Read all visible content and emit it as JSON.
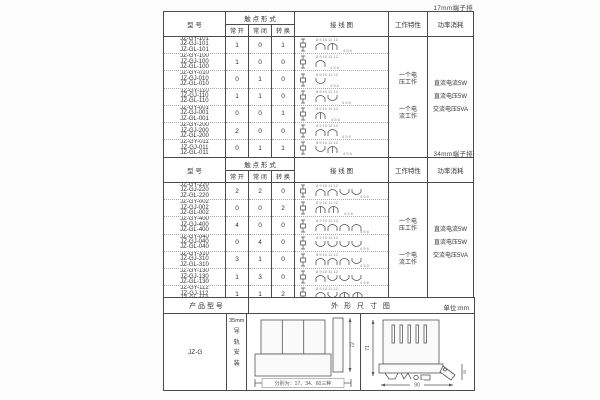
{
  "contact_header": {
    "model": "型 号",
    "contact_form": "触 点 形 式",
    "normally_open": "常 开",
    "normally_closed": "常 闭",
    "changeover": "转 换",
    "wiring_diagram": "接 线 图",
    "working_characteristic": "工作特性",
    "power_consumption": "功率消耗"
  },
  "work_characteristics": [
    "一个电压工作",
    "一个电流工作"
  ],
  "power_consumptions": [
    "直流电流5W",
    "直流电压5W",
    "交流电压5VA"
  ],
  "table_17mm": {
    "corner_label": "17mm端子排",
    "diagram_terminals_top": "8 9 10 11 12",
    "diagram_terminals_bottom": "4 5 6",
    "rows": [
      {
        "models": [
          "JZ-GY-101",
          "JZ-GJ-101",
          "JZ-GL-101"
        ],
        "no": "1",
        "nc": "0",
        "co": "1"
      },
      {
        "models": [
          "JZ-GY-100",
          "JZ-GJ-100",
          "JZ-GL-100"
        ],
        "no": "1",
        "nc": "0",
        "co": "0"
      },
      {
        "models": [
          "JZ-GY-010",
          "JZ-GJ-010",
          "JZ-GL-010"
        ],
        "no": "0",
        "nc": "1",
        "co": "0"
      },
      {
        "models": [
          "JZ-GY-110",
          "JZ-GJ-110",
          "JZ-GL-110"
        ],
        "no": "1",
        "nc": "1",
        "co": "0"
      },
      {
        "models": [
          "JZ-GY-001",
          "JZ-GJ-001",
          "JZ-GL-001"
        ],
        "no": "0",
        "nc": "0",
        "co": "1"
      },
      {
        "models": [
          "JZ-GY-200",
          "JZ-GJ-200",
          "JZ-GL-200"
        ],
        "no": "2",
        "nc": "0",
        "co": "0"
      },
      {
        "models": [
          "JZ-GY-011",
          "JZ-GJ-011",
          "JZ-GL-011"
        ],
        "no": "0",
        "nc": "1",
        "co": "1"
      }
    ]
  },
  "table_34mm": {
    "corner_label": "34mm端子排",
    "diagram_terminals_top": "8 9 10 11 12",
    "diagram_terminals_bottom": "4 5 6",
    "rows": [
      {
        "models": [
          "JZ-GY-220",
          "JZ-GJ-220",
          "JZ-GL-220"
        ],
        "no": "2",
        "nc": "2",
        "co": "0"
      },
      {
        "models": [
          "JZ-GY-002",
          "JZ-GJ-002",
          "JZ-GL-002"
        ],
        "no": "0",
        "nc": "0",
        "co": "2"
      },
      {
        "models": [
          "JZ-GY-400",
          "JZ-GJ-400",
          "JZ-GL-400"
        ],
        "no": "4",
        "nc": "0",
        "co": "0"
      },
      {
        "models": [
          "JZ-GY-040",
          "JZ-GJ-040",
          "JZ-GL-040"
        ],
        "no": "0",
        "nc": "4",
        "co": "0"
      },
      {
        "models": [
          "JZ-GY-310",
          "JZ-GJ-310",
          "JZ-GL-310"
        ],
        "no": "3",
        "nc": "1",
        "co": "0"
      },
      {
        "models": [
          "JZ-GY-130",
          "JZ-GJ-130",
          "JZ-GL-130"
        ],
        "no": "1",
        "nc": "3",
        "co": "0"
      },
      {
        "models": [
          "JZ-GY-112",
          "JZ-GJ-112",
          "JZ-GL-112"
        ],
        "no": "1",
        "nc": "1",
        "co": "2"
      }
    ]
  },
  "outline_table": {
    "header_product_model": "产 品 型 号",
    "header_outline": "外 形 尺 寸 图",
    "unit": "单位:mm",
    "model": "JZ-G",
    "mounting_size": "35mm",
    "mounting_text": "导轨安装",
    "caption": "分别为：17、34、60三种",
    "dims": {
      "front_height": "72",
      "side_height": "71",
      "side_width": "90",
      "side_depth": "35"
    }
  }
}
